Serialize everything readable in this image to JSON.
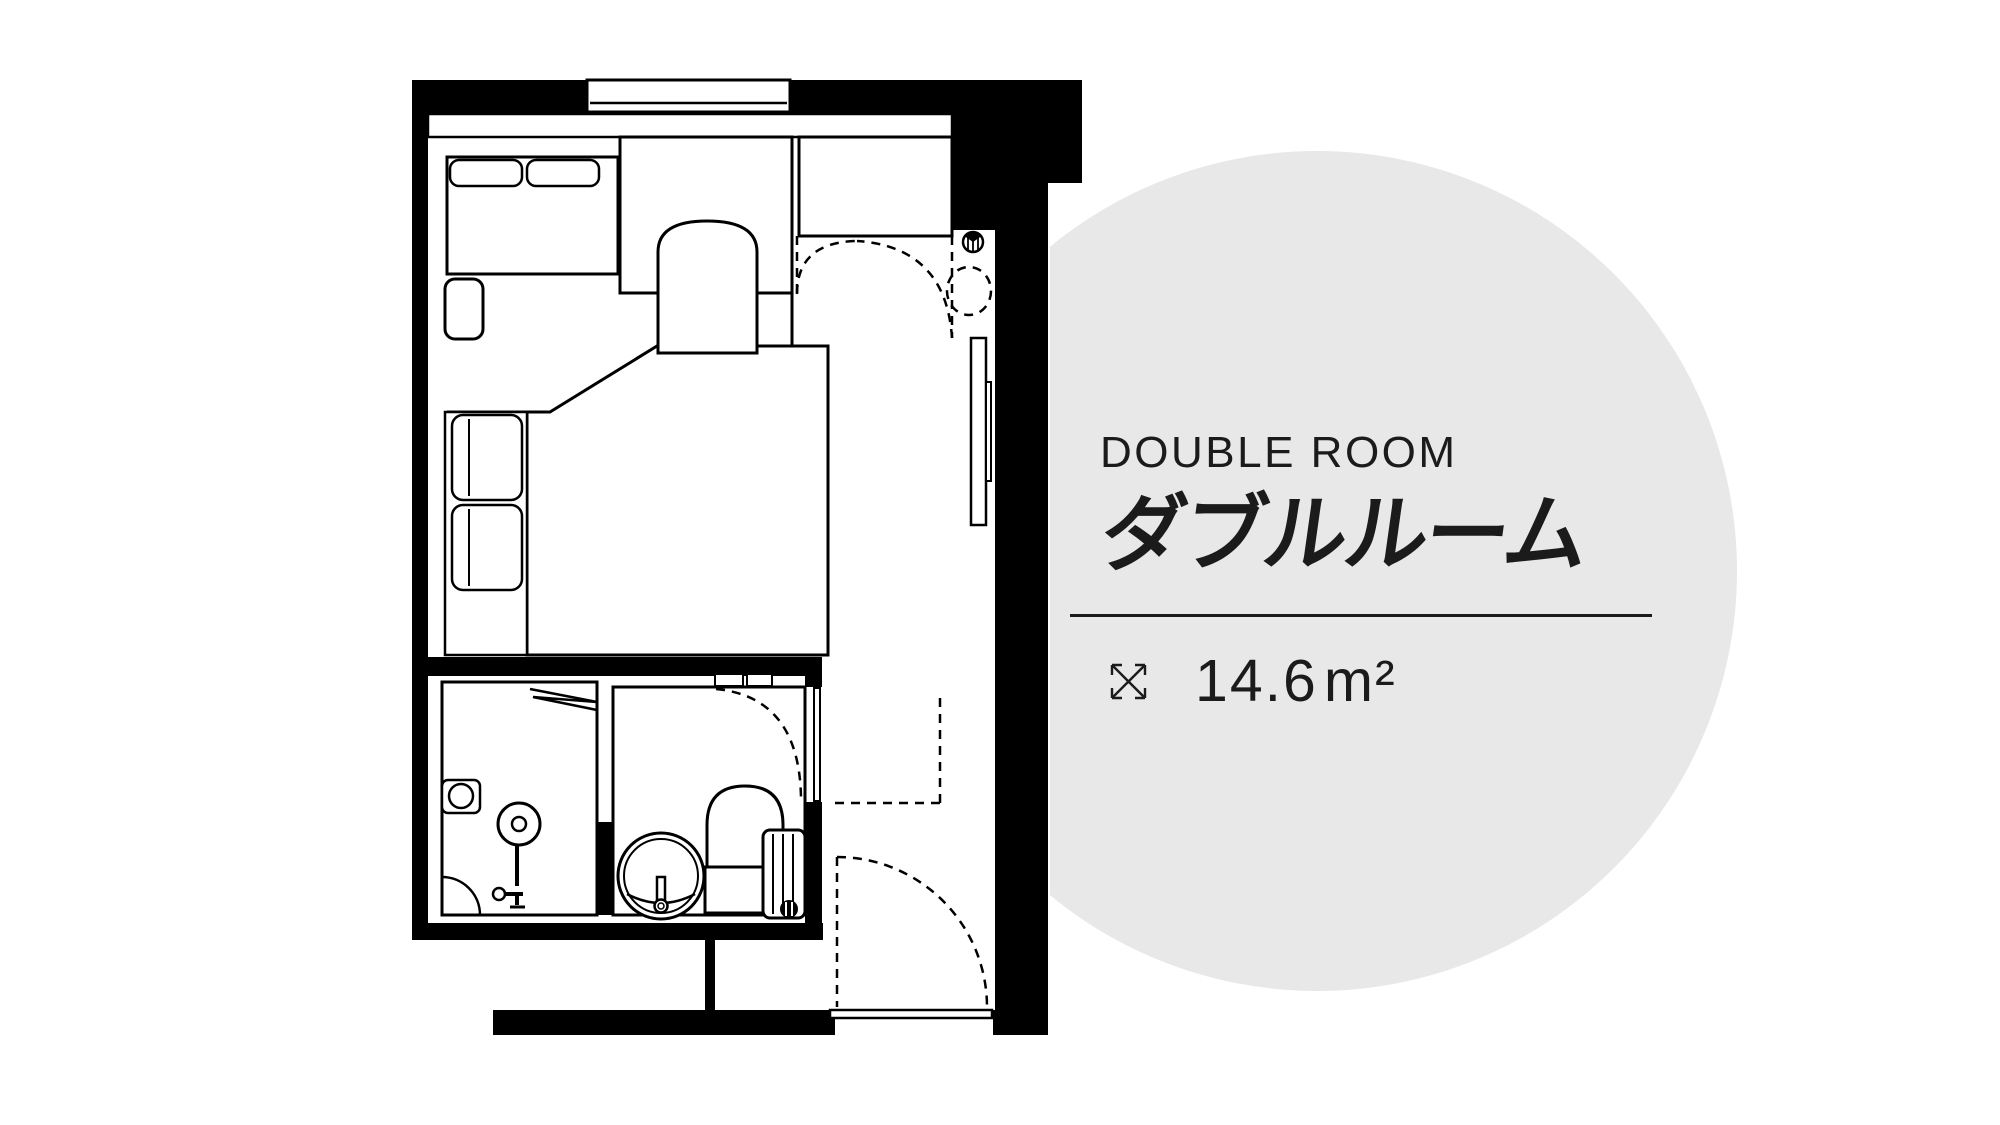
{
  "panel": {
    "title_en": "DOUBLE ROOM",
    "title_ja": "ダブルルーム",
    "area_value": "14.6",
    "area_unit": "m²"
  },
  "colors": {
    "background": "#ffffff",
    "circle": "#e8e8e8",
    "plan_ink": "#000000",
    "text": "#1b1b1b"
  },
  "icons": [
    {
      "name": "expand-arrows-icon",
      "meaning": "room floor area dimensions"
    },
    {
      "name": "sprinkler-icon",
      "meaning": "pipe shaft / sprinkler symbol in entry alcove"
    }
  ],
  "floor_plan": {
    "type": "hotel-guest-room",
    "rooms": [
      "bedroom",
      "shower-room",
      "toilet-room",
      "entry-corridor",
      "closet"
    ],
    "furniture": [
      "sofa-bench",
      "desk",
      "chair",
      "double-bed",
      "pillow-shelf",
      "side-table",
      "wall-panel-door",
      "shower-head",
      "soap-niche",
      "towel-shelf",
      "wash-basin",
      "toilet",
      "towel-radiator",
      "entry-door",
      "window"
    ]
  }
}
